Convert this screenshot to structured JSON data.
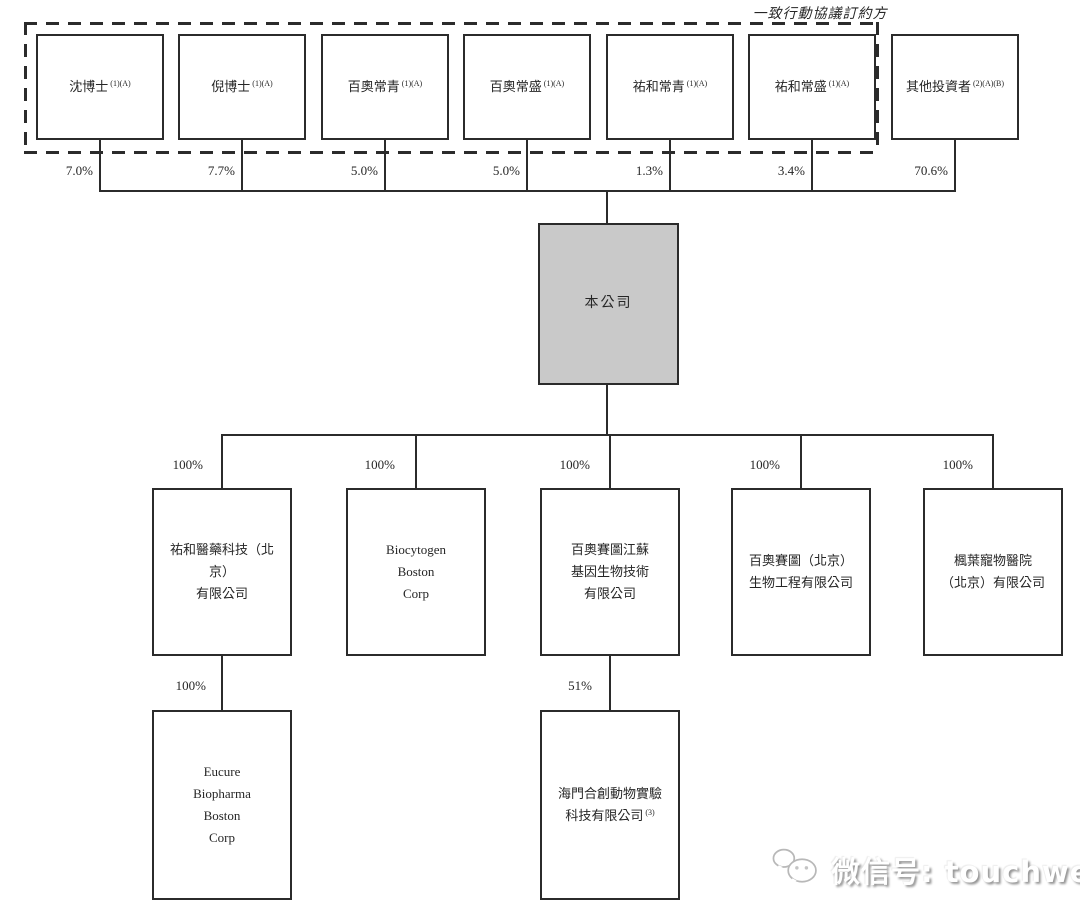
{
  "diagram": {
    "group_label": "一致行動協議訂約方",
    "shareholders": [
      {
        "name": "沈博士",
        "note": "(1)(A)",
        "pct": "7.0%"
      },
      {
        "name": "倪博士",
        "note": "(1)(A)",
        "pct": "7.7%"
      },
      {
        "name": "百奧常青",
        "note": "(1)(A)",
        "pct": "5.0%"
      },
      {
        "name": "百奧常盛",
        "note": "(1)(A)",
        "pct": "5.0%"
      },
      {
        "name": "祐和常青",
        "note": "(1)(A)",
        "pct": "1.3%"
      },
      {
        "name": "祐和常盛",
        "note": "(1)(A)",
        "pct": "3.4%"
      },
      {
        "name": "其他投資者",
        "note": "(2)(A)(B)",
        "pct": "70.6%"
      }
    ],
    "company": {
      "name": "本公司"
    },
    "subsidiaries": [
      {
        "name": "祐和醫藥科技（北京）\n有限公司",
        "pct": "100%"
      },
      {
        "name": "Biocytogen\nBoston\nCorp",
        "pct": "100%"
      },
      {
        "name": "百奧賽圖江蘇\n基因生物技術\n有限公司",
        "pct": "100%"
      },
      {
        "name": "百奧賽圖（北京）\n生物工程有限公司",
        "pct": "100%"
      },
      {
        "name": "楓葉寵物醫院\n（北京）有限公司",
        "pct": "100%"
      }
    ],
    "sub_subsidiaries": [
      {
        "name": "Eucure\nBiopharma\nBoston\nCorp",
        "note": "",
        "pct": "100%"
      },
      {
        "name": "海門合創動物實驗\n科技有限公司",
        "note": "(3)",
        "pct": "51%"
      }
    ]
  },
  "watermark": {
    "label": "微信号: touchweb"
  },
  "colors": {
    "line": "#2b2b2b",
    "company_fill": "#c9c9c9",
    "text": "#262626"
  }
}
